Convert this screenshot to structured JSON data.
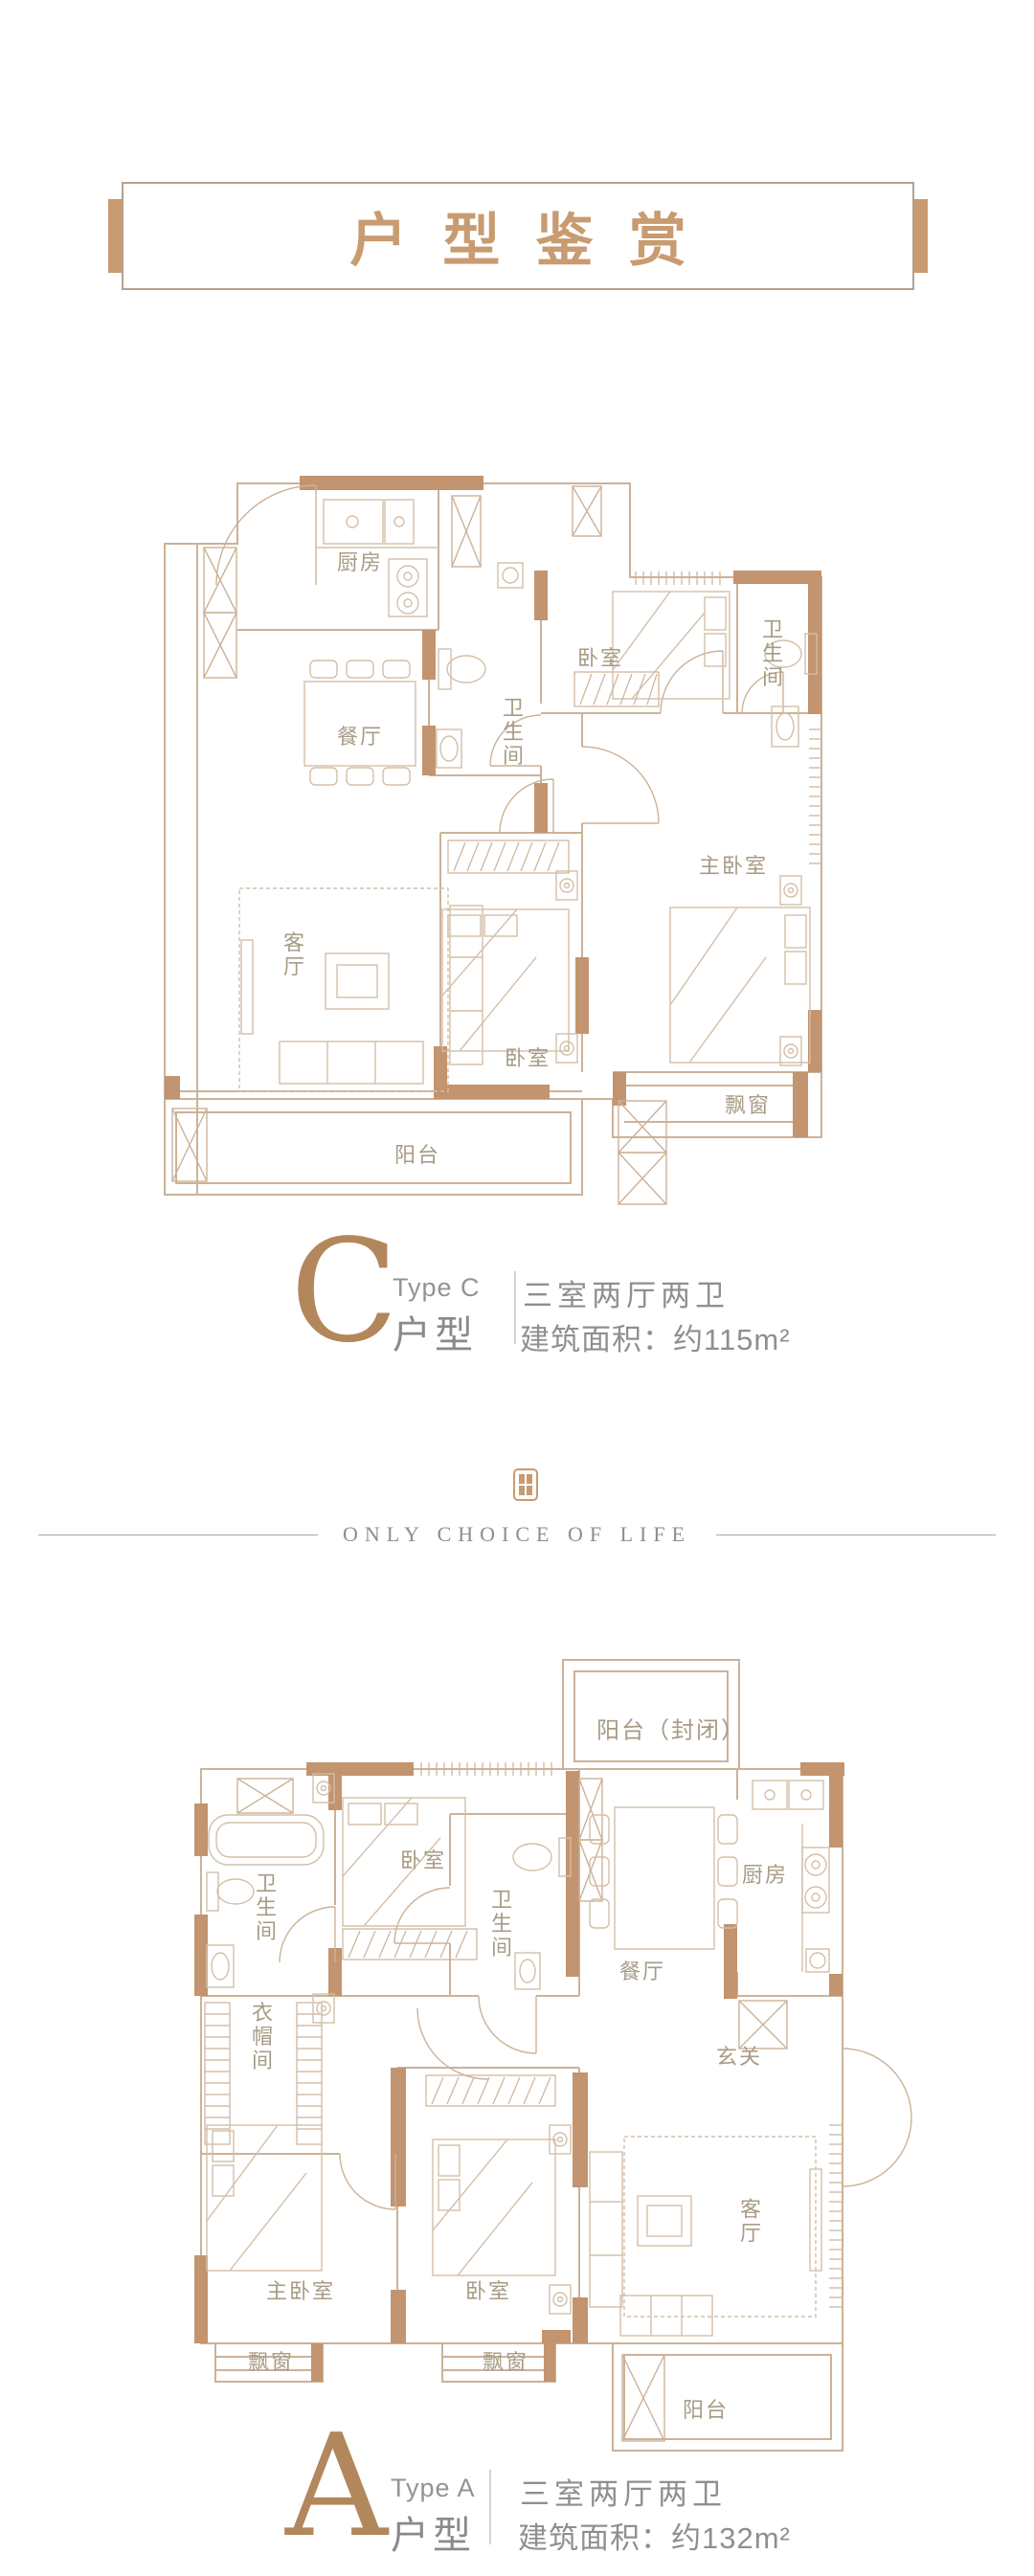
{
  "banner": {
    "title": "户型鉴赏"
  },
  "plan_c": {
    "letter": "C",
    "type_en": "Type C",
    "type_label": "户型",
    "layout": "三室两厅两卫",
    "area": "建筑面积：约115m²",
    "rooms": {
      "kitchen": "厨房",
      "dining": "餐厅",
      "bath_center": "卫生间",
      "bed_top": "卧室",
      "bath_right": "卫生间",
      "master": "主卧室",
      "living": "客厅",
      "bed_bottom": "卧室",
      "bay": "飘窗",
      "balcony": "阳台"
    }
  },
  "divider": {
    "text": "ONLY CHOICE OF LIFE"
  },
  "plan_a": {
    "letter": "A",
    "type_en": "Type A",
    "type_label": "户型",
    "layout": "三室两厅两卫",
    "area": "建筑面积：约132m²",
    "rooms": {
      "balcony_top": "阳台（封闭）",
      "bath_left": "卫生间",
      "bed_top": "卧室",
      "bath_mid": "卫生间",
      "dining": "餐厅",
      "kitchen": "厨房",
      "cloak": "衣帽间",
      "foyer": "玄关",
      "master": "主卧室",
      "bed_bottom": "卧室",
      "living": "客厅",
      "bay_left": "飘窗",
      "bay_right": "飘窗",
      "balcony": "阳台"
    }
  },
  "colors": {
    "wall_accent": "#c2946f",
    "thin_line": "#ccb298",
    "room_label": "#a79b85",
    "gray_text": "#8e8e8e",
    "letter_tan": "#b3875c"
  }
}
